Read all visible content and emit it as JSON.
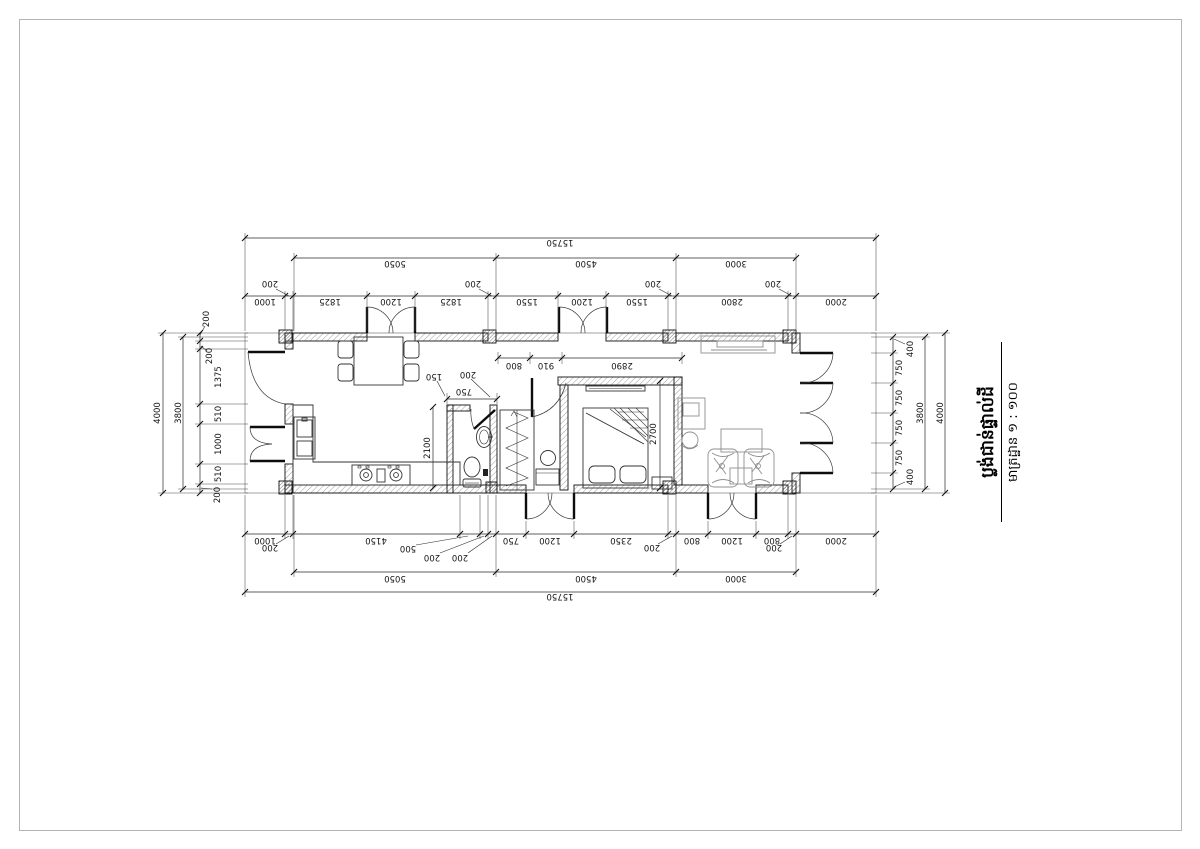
{
  "drawing": {
    "title": "ប្លង់ជាន់ផ្ទាល់ដី",
    "scale_label": "មាត្រដ្ឋាន ១ : ១០០"
  },
  "dims": {
    "top": {
      "overall": "15750",
      "groups": [
        "5050",
        "4500",
        "3000"
      ],
      "wall_labels": [
        "200",
        "200",
        "200",
        "200"
      ],
      "segments": [
        "1000",
        "1825",
        "1200",
        "1825",
        "1550",
        "1200",
        "1550",
        "2800",
        "2000"
      ]
    },
    "bottom": {
      "overall": "15750",
      "groups": [
        "5050",
        "4500",
        "3000"
      ],
      "leader_labels": [
        "200",
        "500",
        "200",
        "200",
        "200",
        "200"
      ],
      "segments": [
        "1000",
        "4150",
        "750",
        "1200",
        "2350",
        "800",
        "1200",
        "800",
        "2000"
      ]
    },
    "left": {
      "overall": "4000",
      "inner": "3800",
      "wall_labels": [
        "200",
        "200",
        "200"
      ],
      "segments": [
        "1375",
        "510",
        "1000",
        "510"
      ]
    },
    "right": {
      "overall": "4000",
      "inner": "3800",
      "wall_labels": [
        "400",
        "400"
      ],
      "segments": [
        "750",
        "750",
        "750",
        "750"
      ]
    },
    "interior": {
      "stair_width": "800",
      "hall_width": "910",
      "bedroom_width": "2890",
      "bedroom_depth": "2700",
      "kitchen_depth": "2100",
      "bath_labels": [
        "150",
        "200",
        "750"
      ]
    }
  }
}
